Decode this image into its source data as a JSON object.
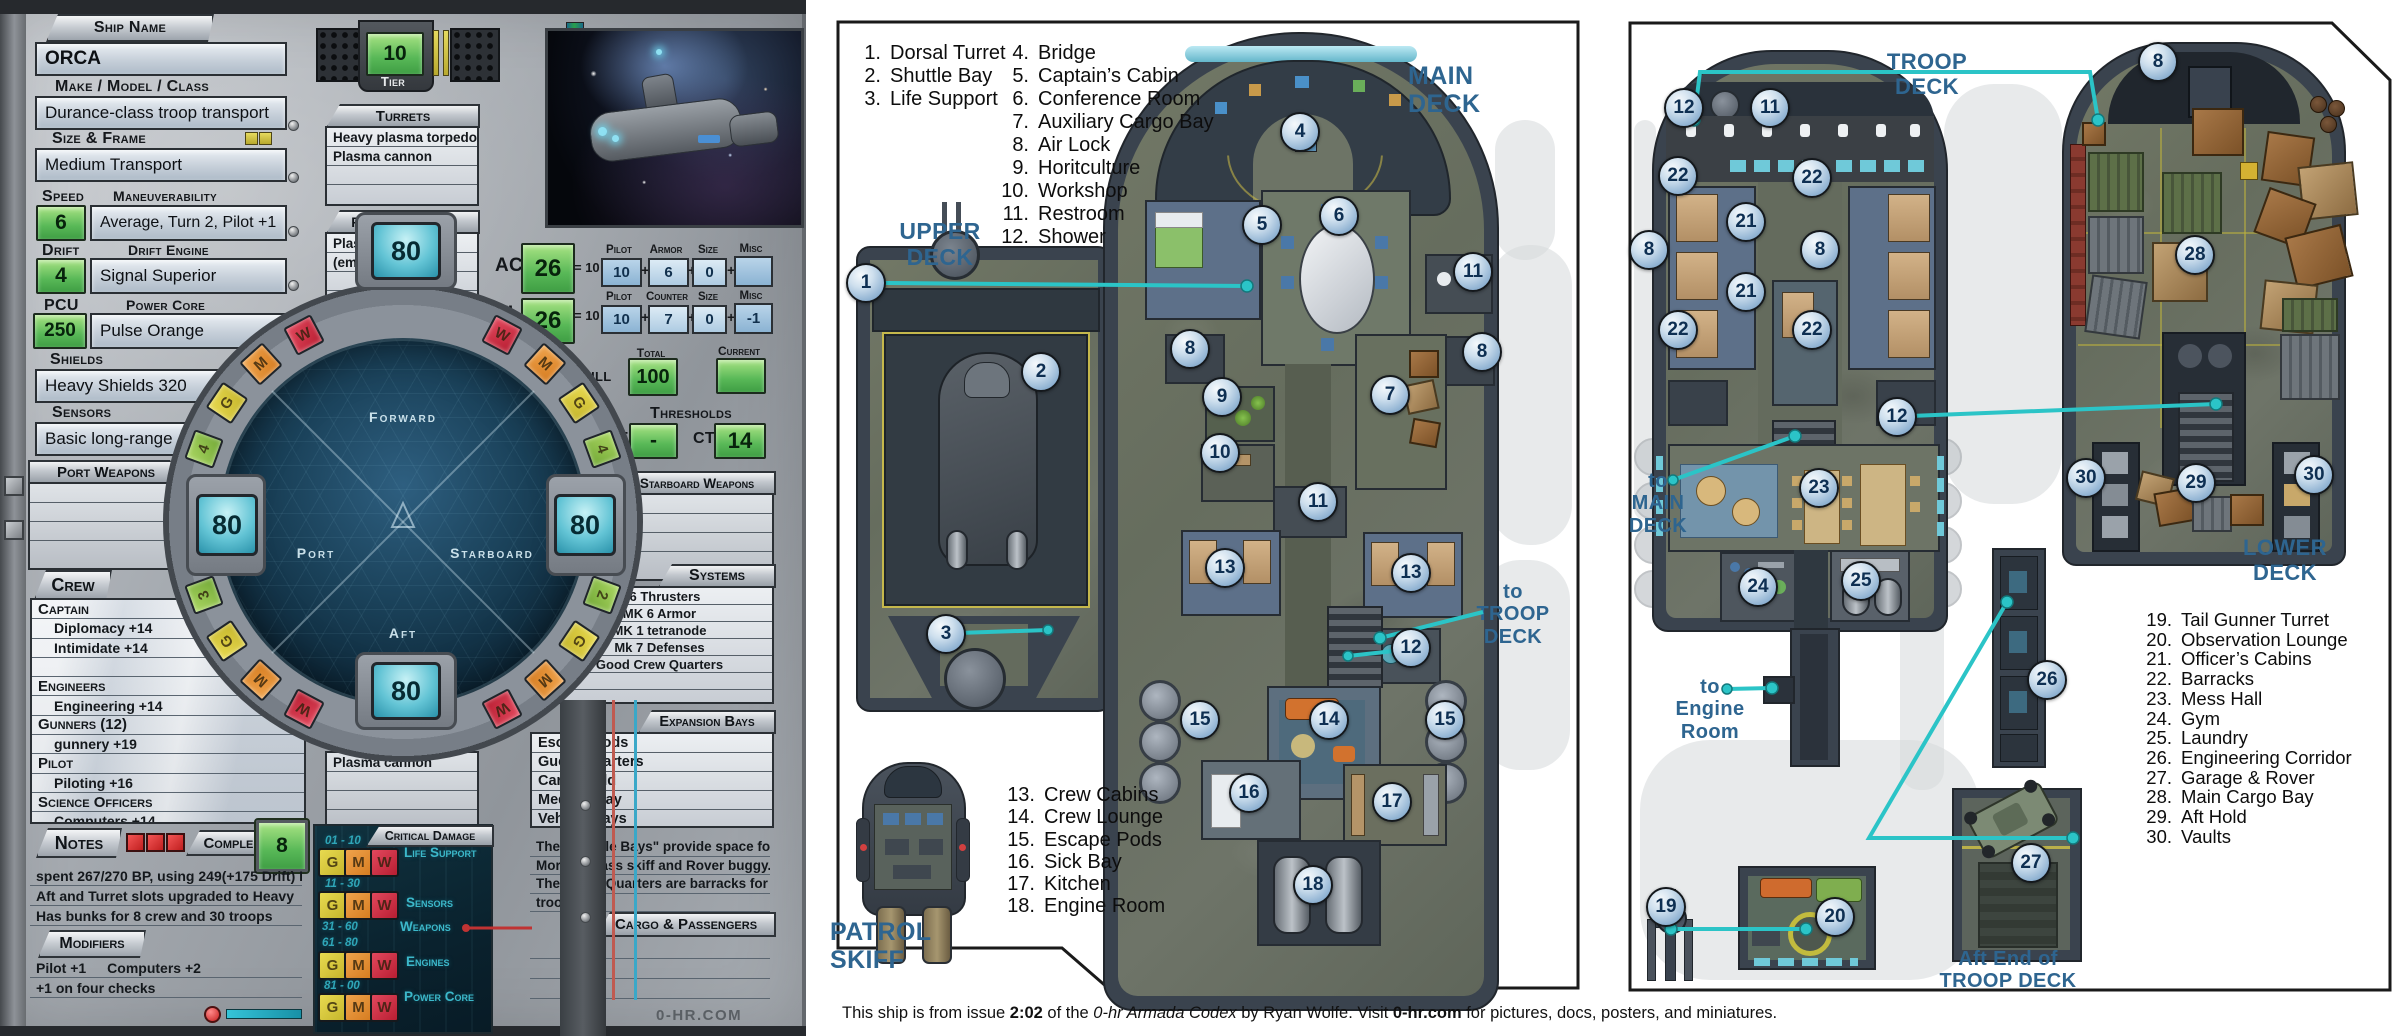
{
  "sheet": {
    "labels": {
      "ship_name": "Ship Name",
      "make": "Make / Model / Class",
      "size": "Size & Frame",
      "speed": "Speed",
      "maneuverability": "Maneuverability",
      "drift": "Drift",
      "drift_engine": "Drift Engine",
      "pcu": "PCU",
      "power_core": "Power Core",
      "shields": "Shields",
      "sensors": "Sensors",
      "port_weapons": "Port Weapons",
      "crew": "Crew",
      "notes": "Notes",
      "complement": "Complement",
      "modifiers": "Modifiers",
      "tier": "Tier",
      "turrets": "Turrets",
      "forward_weapons": "Forward Weapons",
      "starboard_weapons": "Starboard Weapons",
      "aft_weapons": "Aft Weapons",
      "systems": "Systems",
      "expansion_bays": "Expansion Bays",
      "cargo": "Cargo & Passengers",
      "critical": "Critical Damage",
      "hull": "Hull",
      "total": "Total",
      "current": "Current",
      "thresholds": "Thresholds",
      "dt": "DT",
      "ct": "CT"
    },
    "values": {
      "ship_name": "ORCA",
      "make": "Durance-class troop transport",
      "size": "Medium Transport",
      "speed": "6",
      "maneuverability": "Average, Turn 2, Pilot +1",
      "drift": "4",
      "drift_engine": "Signal Superior",
      "pcu": "250",
      "power_core": "Pulse Orange",
      "shields": "Heavy Shields 320",
      "sensors": "Basic long-range",
      "tier": "10",
      "hull_total": "100",
      "hull_current": "",
      "dt": "-",
      "ct": "14",
      "complement": "8"
    },
    "plus": "+",
    "ac": {
      "label": "AC",
      "value": "26",
      "eq": "= 10 +",
      "cols": [
        {
          "h": "Pilot",
          "v": "10"
        },
        {
          "h": "Armor",
          "v": "6"
        },
        {
          "h": "Size",
          "v": "0"
        },
        {
          "h": "Misc",
          "v": ""
        }
      ]
    },
    "tl": {
      "label": "TL",
      "value": "26",
      "eq": "= 10 +",
      "cols": [
        {
          "h": "Pilot",
          "v": "10"
        },
        {
          "h": "Counter",
          "v": "7"
        },
        {
          "h": "Size",
          "v": "0"
        },
        {
          "h": "Misc",
          "v": "-1"
        }
      ]
    },
    "turrets": [
      "Heavy plasma torpedo lau",
      "Plasma cannon",
      "",
      ""
    ],
    "forward": [
      "Plasma cannon",
      "(empty)",
      "",
      ""
    ],
    "aft": [
      "Plasma cannon",
      "",
      "",
      ""
    ],
    "port": [
      "",
      "",
      "",
      ""
    ],
    "starboard": [
      "",
      "",
      "",
      ""
    ],
    "systems": [
      "M6 Thrusters",
      "MK 6 Armor",
      "MK 1 tetranode",
      "Mk 7 Defenses",
      "Good Crew Quarters",
      "",
      ""
    ],
    "expansion": [
      "Escape Pods",
      "Guest Quarters",
      "Cargo Hold",
      "Medical Bay",
      "Vehicle Bays"
    ],
    "expansion_notes": [
      "The \"Vehicle Bays\" provide space for the",
      "Morgan-class skiff and Rover buggy.",
      "The Guest Quarters are barracks for 30",
      "troops."
    ],
    "crew_lines": [
      {
        "cls": "role",
        "text": "Captain"
      },
      {
        "cls": "skill",
        "text": "Diplomacy +14"
      },
      {
        "cls": "skill",
        "text": "Intimidate +14"
      },
      {
        "cls": "skill",
        "text": ""
      },
      {
        "cls": "role",
        "text": "Engineers"
      },
      {
        "cls": "skill",
        "text": "Engineering +14"
      },
      {
        "cls": "role",
        "text": "Gunners  (12)"
      },
      {
        "cls": "skill",
        "text": "gunnery  +19"
      },
      {
        "cls": "role",
        "text": "Pilot"
      },
      {
        "cls": "skill",
        "text": "Piloting +16"
      },
      {
        "cls": "role",
        "text": "Science Officers"
      },
      {
        "cls": "skill",
        "text": "Computers +14"
      }
    ],
    "notes_lines": [
      "spent  267/270 BP,  using 249(+175 Drift)  PCU",
      "Aft and Turret slots upgraded to Heavy",
      "Has bunks for 8 crew and 30 troops"
    ],
    "modifier_lines": [
      "Pilot +1  Computers +2",
      "+1 on four checks"
    ],
    "gmw": [
      "G",
      "M",
      "W"
    ],
    "crit": {
      "rows": [
        {
          "range": "01 - 10",
          "name": "Life Support"
        },
        {
          "range": "11 - 30",
          "name": "Sensors"
        },
        {
          "range": "31 - 60",
          "name": "Weapons"
        },
        {
          "range": "61 - 80",
          "name": "Engines"
        },
        {
          "range": "81 - 00",
          "name": "Power Core"
        }
      ]
    },
    "brand": "0-HR.COM"
  },
  "dial": {
    "shield_fwd": "80",
    "shield_port": "80",
    "shield_stbd": "80",
    "shield_aft": "80",
    "forward": "Forward",
    "port": "Port",
    "starboard": "Starboard",
    "aft": "Aft",
    "chips": [
      {
        "ch": "W",
        "cls": "c-w",
        "x": 304,
        "y": 335,
        "r": -28
      },
      {
        "ch": "M",
        "cls": "c-m",
        "x": 261,
        "y": 364,
        "r": -42
      },
      {
        "ch": "G",
        "cls": "c-g",
        "x": 227,
        "y": 403,
        "r": -56
      },
      {
        "ch": "4",
        "cls": "c-n",
        "x": 204,
        "y": 449,
        "r": -70
      },
      {
        "ch": "W",
        "cls": "c-w",
        "x": 502,
        "y": 335,
        "r": 28
      },
      {
        "ch": "M",
        "cls": "c-m",
        "x": 545,
        "y": 364,
        "r": 42
      },
      {
        "ch": "G",
        "cls": "c-g",
        "x": 579,
        "y": 403,
        "r": 56
      },
      {
        "ch": "4",
        "cls": "c-n",
        "x": 602,
        "y": 449,
        "r": 70
      },
      {
        "ch": "3",
        "cls": "c-n",
        "x": 204,
        "y": 595,
        "r": -110
      },
      {
        "ch": "G",
        "cls": "c-g",
        "x": 227,
        "y": 641,
        "r": -124
      },
      {
        "ch": "M",
        "cls": "c-m",
        "x": 261,
        "y": 680,
        "r": -138
      },
      {
        "ch": "W",
        "cls": "c-w",
        "x": 304,
        "y": 709,
        "r": -152
      },
      {
        "ch": "2",
        "cls": "c-n",
        "x": 602,
        "y": 595,
        "r": 110
      },
      {
        "ch": "G",
        "cls": "c-g",
        "x": 579,
        "y": 641,
        "r": 124
      },
      {
        "ch": "M",
        "cls": "c-m",
        "x": 545,
        "y": 680,
        "r": 138
      },
      {
        "ch": "W",
        "cls": "c-w",
        "x": 502,
        "y": 709,
        "r": 152
      }
    ]
  },
  "mid": {
    "upper1": "UPPER",
    "upper2": "DECK",
    "main1": "MAIN",
    "main2": "DECK",
    "to_troop": [
      "to",
      "TROOP",
      "DECK"
    ],
    "patrol": "PATROL SKIFF",
    "legend1": [
      {
        "n": "1.",
        "t": "Dorsal Turret"
      },
      {
        "n": "2.",
        "t": "Shuttle Bay"
      },
      {
        "n": "3.",
        "t": "Life Support"
      }
    ],
    "legend2": [
      {
        "n": "4.",
        "t": "Bridge"
      },
      {
        "n": "5.",
        "t": "Captain’s Cabin"
      },
      {
        "n": "6.",
        "t": "Conference Room"
      },
      {
        "n": "7.",
        "t": "Auxiliary Cargo Bay"
      },
      {
        "n": "8.",
        "t": "Air Lock"
      },
      {
        "n": "9.",
        "t": "Horitculture"
      },
      {
        "n": "10.",
        "t": "Workshop"
      },
      {
        "n": "11.",
        "t": "Restroom"
      },
      {
        "n": "12.",
        "t": "Shower"
      }
    ],
    "legend3": [
      {
        "n": "13.",
        "t": "Crew Cabins"
      },
      {
        "n": "14.",
        "t": "Crew Lounge"
      },
      {
        "n": "15.",
        "t": "Escape Pods"
      },
      {
        "n": "16.",
        "t": "Sick Bay"
      },
      {
        "n": "17.",
        "t": "Kitchen"
      },
      {
        "n": "18.",
        "t": "Engine Room"
      }
    ],
    "markers": [
      {
        "n": "1",
        "x": 866,
        "y": 283
      },
      {
        "n": "2",
        "x": 1041,
        "y": 372
      },
      {
        "n": "3",
        "x": 946,
        "y": 634
      },
      {
        "n": "4",
        "x": 1300,
        "y": 132
      },
      {
        "n": "5",
        "x": 1262,
        "y": 225
      },
      {
        "n": "6",
        "x": 1339,
        "y": 216
      },
      {
        "n": "7",
        "x": 1390,
        "y": 395
      },
      {
        "n": "8",
        "x": 1190,
        "y": 349
      },
      {
        "n": "8",
        "x": 1482,
        "y": 352
      },
      {
        "n": "9",
        "x": 1222,
        "y": 397
      },
      {
        "n": "10",
        "x": 1220,
        "y": 453
      },
      {
        "n": "11",
        "x": 1473,
        "y": 272
      },
      {
        "n": "11",
        "x": 1318,
        "y": 502
      },
      {
        "n": "12",
        "x": 1411,
        "y": 648
      },
      {
        "n": "13",
        "x": 1225,
        "y": 568
      },
      {
        "n": "13",
        "x": 1411,
        "y": 573
      },
      {
        "n": "14",
        "x": 1329,
        "y": 720
      },
      {
        "n": "15",
        "x": 1200,
        "y": 720
      },
      {
        "n": "15",
        "x": 1445,
        "y": 720
      },
      {
        "n": "16",
        "x": 1249,
        "y": 793
      },
      {
        "n": "17",
        "x": 1392,
        "y": 802
      },
      {
        "n": "18",
        "x": 1313,
        "y": 885
      }
    ]
  },
  "right": {
    "troop1": "TROOP",
    "troop2": "DECK",
    "lower1": "LOWER",
    "lower2": "DECK",
    "to_main": [
      "to",
      "MAIN",
      "DECK"
    ],
    "to_engine1": "to",
    "to_engine2": "Engine Room",
    "aft_end1": "Aft End of",
    "aft_end2": "TROOP DECK",
    "legend": [
      {
        "n": "19.",
        "t": "Tail Gunner Turret"
      },
      {
        "n": "20.",
        "t": "Observation Lounge"
      },
      {
        "n": "",
        "t": ""
      },
      {
        "n": "21.",
        "t": "Officer’s Cabins"
      },
      {
        "n": "22.",
        "t": "Barracks"
      },
      {
        "n": "23.",
        "t": "Mess Hall"
      },
      {
        "n": "24.",
        "t": "Gym"
      },
      {
        "n": "25.",
        "t": "Laundry"
      },
      {
        "n": "26.",
        "t": "Engineering Corridor"
      },
      {
        "n": "27.",
        "t": "Garage & Rover"
      },
      {
        "n": "",
        "t": ""
      },
      {
        "n": "28.",
        "t": "Main Cargo Bay"
      },
      {
        "n": "29.",
        "t": "Aft Hold"
      },
      {
        "n": "30.",
        "t": "Vaults"
      }
    ],
    "markers": [
      {
        "n": "12",
        "x": 1684,
        "y": 108
      },
      {
        "n": "11",
        "x": 1770,
        "y": 108
      },
      {
        "n": "22",
        "x": 1678,
        "y": 176
      },
      {
        "n": "22",
        "x": 1812,
        "y": 178
      },
      {
        "n": "21",
        "x": 1746,
        "y": 222
      },
      {
        "n": "21",
        "x": 1746,
        "y": 292
      },
      {
        "n": "8",
        "x": 1649,
        "y": 250
      },
      {
        "n": "8",
        "x": 1820,
        "y": 250
      },
      {
        "n": "22",
        "x": 1678,
        "y": 330
      },
      {
        "n": "22",
        "x": 1812,
        "y": 330
      },
      {
        "n": "12",
        "x": 1897,
        "y": 417
      },
      {
        "n": "23",
        "x": 1819,
        "y": 488
      },
      {
        "n": "24",
        "x": 1758,
        "y": 587
      },
      {
        "n": "25",
        "x": 1861,
        "y": 581
      },
      {
        "n": "26",
        "x": 2047,
        "y": 680
      },
      {
        "n": "19",
        "x": 1666,
        "y": 907
      },
      {
        "n": "20",
        "x": 1835,
        "y": 917
      },
      {
        "n": "27",
        "x": 2031,
        "y": 863
      },
      {
        "n": "8",
        "x": 2158,
        "y": 62
      },
      {
        "n": "28",
        "x": 2195,
        "y": 255
      },
      {
        "n": "30",
        "x": 2086,
        "y": 478
      },
      {
        "n": "29",
        "x": 2196,
        "y": 483
      },
      {
        "n": "30",
        "x": 2314,
        "y": 475
      }
    ]
  },
  "footer": {
    "t1": "This ship is from issue ",
    "b1": "2:02",
    "t2": " of the ",
    "i1": "0-hr Armada Codex",
    "t3": " by Ryan Wolfe.    Visit ",
    "b2": "0-hr.com",
    "t4": " for pictures, docs, posters, and miniatures."
  }
}
